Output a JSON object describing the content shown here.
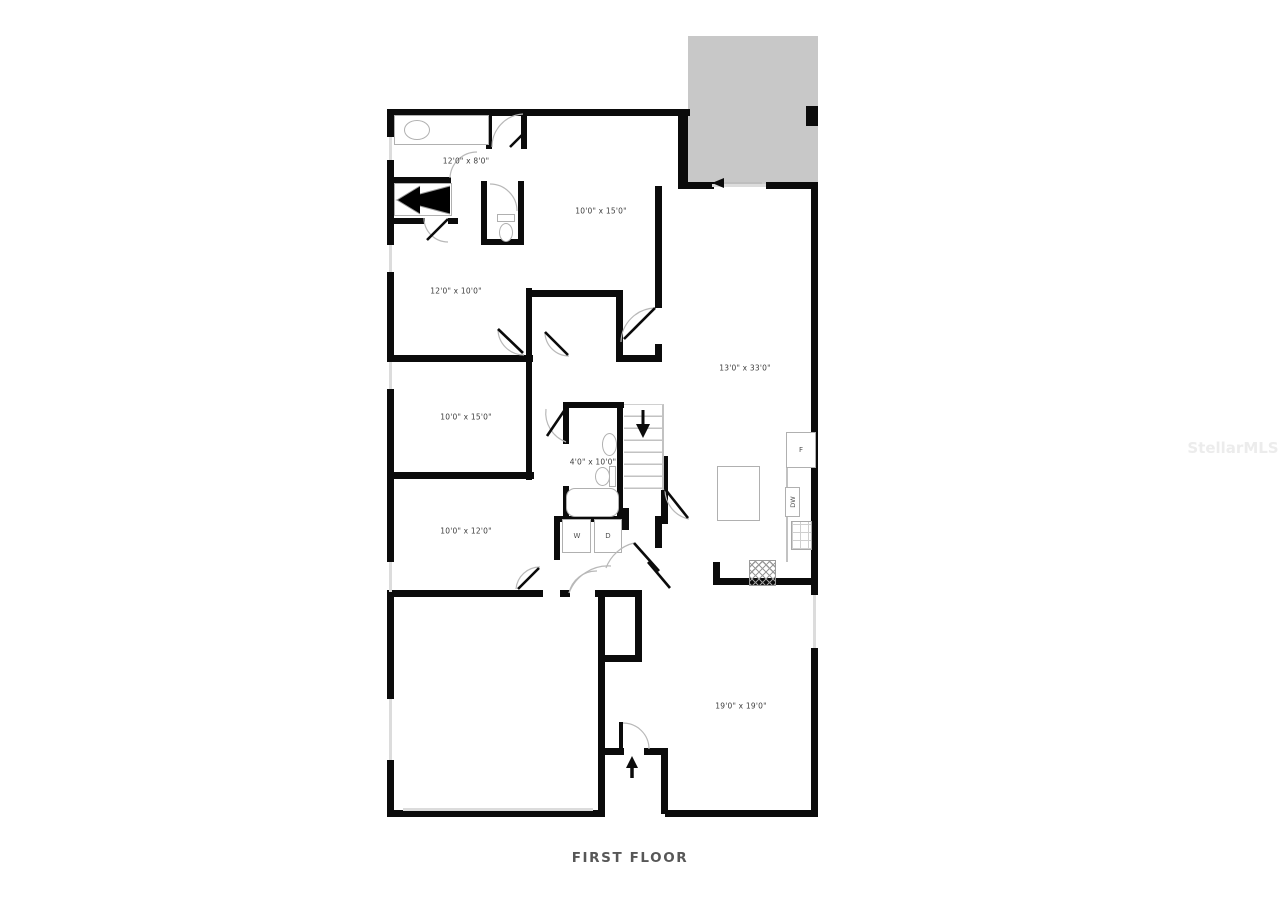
{
  "page": {
    "title": "FIRST FLOOR",
    "watermark": "StellarMLS"
  },
  "colors": {
    "background": "#ffffff",
    "wall": "#0b0b0b",
    "patio_fill": "#c8c8c8",
    "window_line": "#dcdcdc",
    "fixture_outline": "#b0b0b0",
    "door_arc": "#b8b8b8",
    "label_text": "#3d3d3d",
    "title_text": "#575757",
    "watermark_text": "#ececec"
  },
  "floor_plan": {
    "rooms": [
      {
        "name": "primary-bathroom",
        "dimensions": "12'0\" x 8'0\""
      },
      {
        "name": "bedroom-upper",
        "dimensions": "10'0\" x 15'0\""
      },
      {
        "name": "primary-bedroom",
        "dimensions": "12'0\" x 10'0\""
      },
      {
        "name": "great-room",
        "dimensions": "13'0\" x 33'0\""
      },
      {
        "name": "bedroom-middle",
        "dimensions": "10'0\" x 15'0\""
      },
      {
        "name": "hall-bathroom",
        "dimensions": "4'0\" x 10'0\""
      },
      {
        "name": "bedroom-lower",
        "dimensions": "10'0\" x 12'0\""
      },
      {
        "name": "family-room",
        "dimensions": "19'0\" x 19'0\""
      }
    ],
    "appliances": {
      "washer": "W",
      "dryer": "D",
      "refrigerator": "F",
      "dishwasher": "DW"
    }
  }
}
